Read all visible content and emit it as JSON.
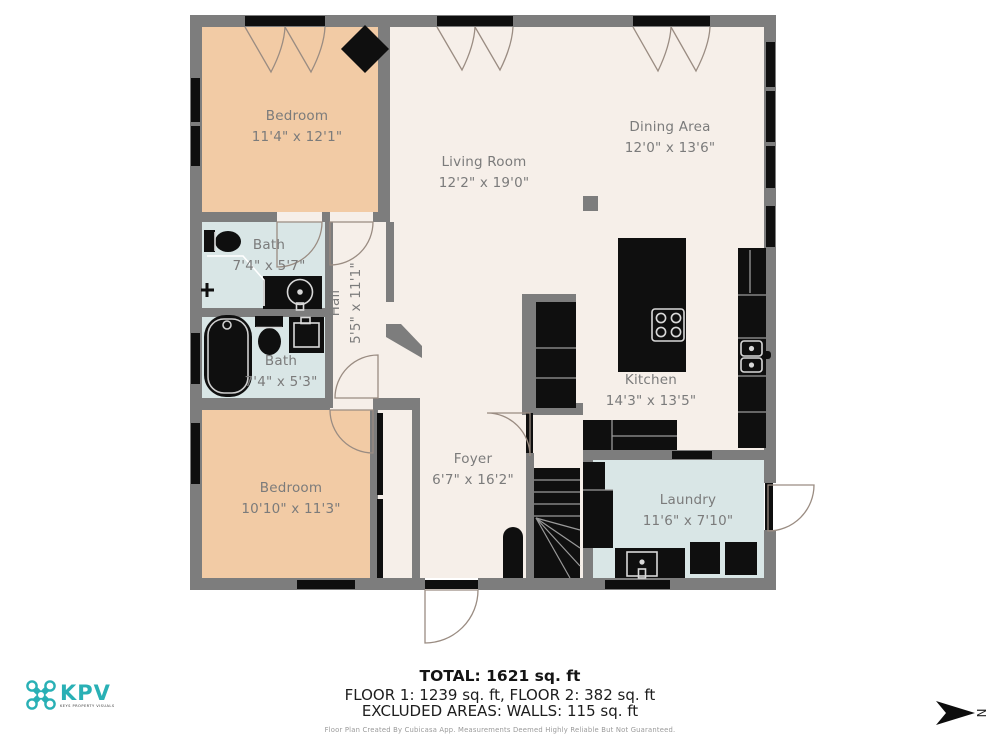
{
  "rooms": [
    {
      "name": "Bedroom",
      "dims": "11'4\" x 12'1\""
    },
    {
      "name": "Living Room",
      "dims": "12'2\" x 19'0\""
    },
    {
      "name": "Dining Area",
      "dims": "12'0\" x 13'6\""
    },
    {
      "name": "Bath",
      "dims": "7'4\" x 5'7\""
    },
    {
      "name": "Hall",
      "dims": "5'5\" x 11'1\""
    },
    {
      "name": "Bath",
      "dims": "7'4\" x 5'3\""
    },
    {
      "name": "Kitchen",
      "dims": "14'3\" x 13'5\""
    },
    {
      "name": "Bedroom",
      "dims": "10'10\" x 11'3\""
    },
    {
      "name": "Foyer",
      "dims": "6'7\" x 16'2\""
    },
    {
      "name": "Laundry",
      "dims": "11'6\" x 7'10\""
    }
  ],
  "summary": {
    "total": "TOTAL: 1621 sq. ft",
    "floors": "FLOOR 1: 1239 sq. ft, FLOOR 2: 382 sq. ft",
    "excluded": "EXCLUDED AREAS: WALLS: 115 sq. ft",
    "disclaimer": "Floor Plan Created By Cubicasa App. Measurements Deemed Highly Reliable But Not Guaranteed."
  },
  "logo": {
    "brand": "KPV",
    "tagline": "KEYS PROPERTY VISUALS"
  },
  "compass": {
    "label": "N"
  },
  "colors": {
    "wall": "#7d7d7d",
    "floor": "#f6efe9",
    "bedroom_floor": "#f2cba5",
    "wet_room_floor": "#d9e6e6",
    "fixture": "#0f0f0f",
    "brand_teal": "#29b0b5",
    "label_text": "#7b7b7b"
  }
}
